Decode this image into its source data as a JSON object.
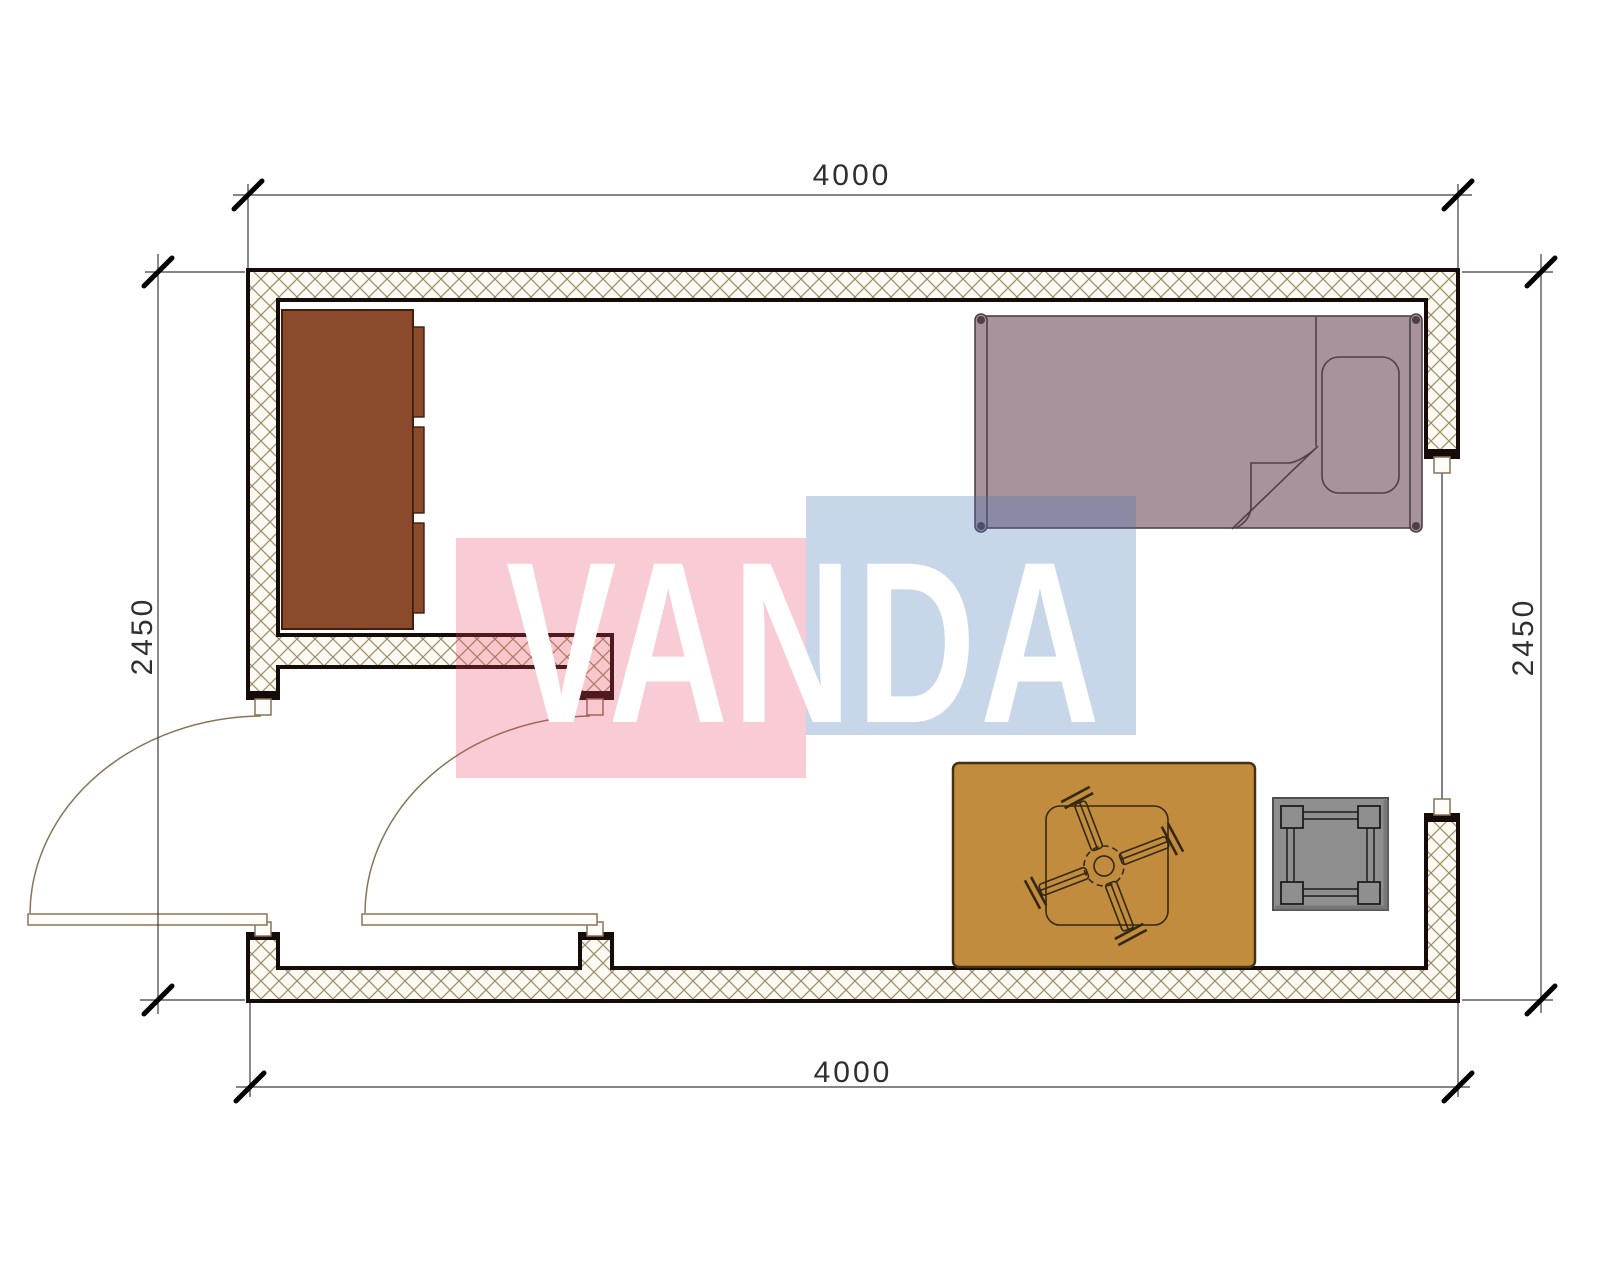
{
  "title": "room-floor-plan",
  "dimensions": {
    "top": "4000",
    "bottom": "4000",
    "left": "2450",
    "right": "2450"
  },
  "watermark": {
    "text": "VANDA"
  },
  "elements": [
    "wardrobe",
    "single-bed",
    "pillow",
    "blanket-fold",
    "rug",
    "ceiling-fan",
    "stool",
    "entry-door-swing",
    "interior-door-swing",
    "window"
  ],
  "colors": {
    "wall-stroke": "#150B08",
    "hatch-line": "#9B8C66",
    "hatch-bg": "#FCFAF3",
    "door": "#8A7355",
    "bed": "#A8929B",
    "bed-stroke": "#4F4048",
    "wardrobe": "#8B4A2B",
    "wardrobe-stroke": "#3E1F0E",
    "rug": "#C18C3E",
    "rug-stroke": "#433112",
    "fan-stroke": "#352812",
    "stool": "#8F8F8F",
    "stool-stroke": "#1D1D1D",
    "watermark-pink": "#E84060",
    "watermark-blue": "#4A76B8",
    "dim-line": "#3C3C3C",
    "dim-text": "#2F2F2F"
  }
}
